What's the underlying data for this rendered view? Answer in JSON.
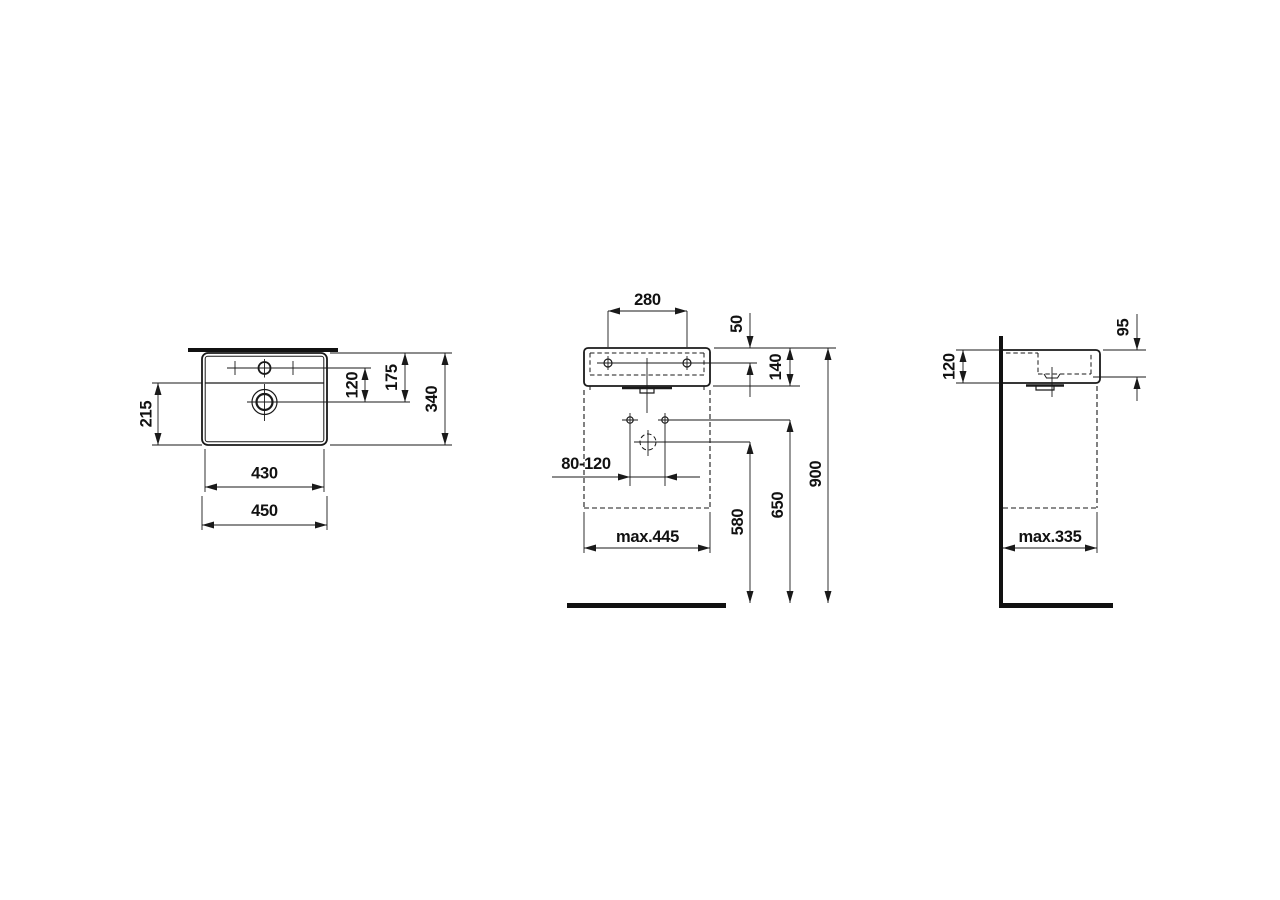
{
  "document_type": "technical-dimension-drawing",
  "subject": "wall-mounted washbasin, three orthographic views",
  "colors": {
    "background": "#ffffff",
    "ink": "#1a1a1a"
  },
  "views": {
    "plan": {
      "label": "top view",
      "dims": {
        "width_outer": "450",
        "width_inner": "430",
        "divider_to_front": "215",
        "tap_to_drain": "120",
        "back_to_drain": "175",
        "depth": "340"
      }
    },
    "front": {
      "label": "front view",
      "dims": {
        "tap_hole_spacing": "280",
        "top_to_tap_hole": "50",
        "basin_height": "140",
        "fixing_bolt_spacing": "80-120",
        "siphon_cover_width": "max.445",
        "drain_height": "580",
        "fixing_height": "650",
        "rim_height": "900"
      }
    },
    "side": {
      "label": "side view",
      "dims": {
        "height_at_wall": "120",
        "height_at_front": "95",
        "siphon_cover_depth": "max.335"
      }
    }
  }
}
